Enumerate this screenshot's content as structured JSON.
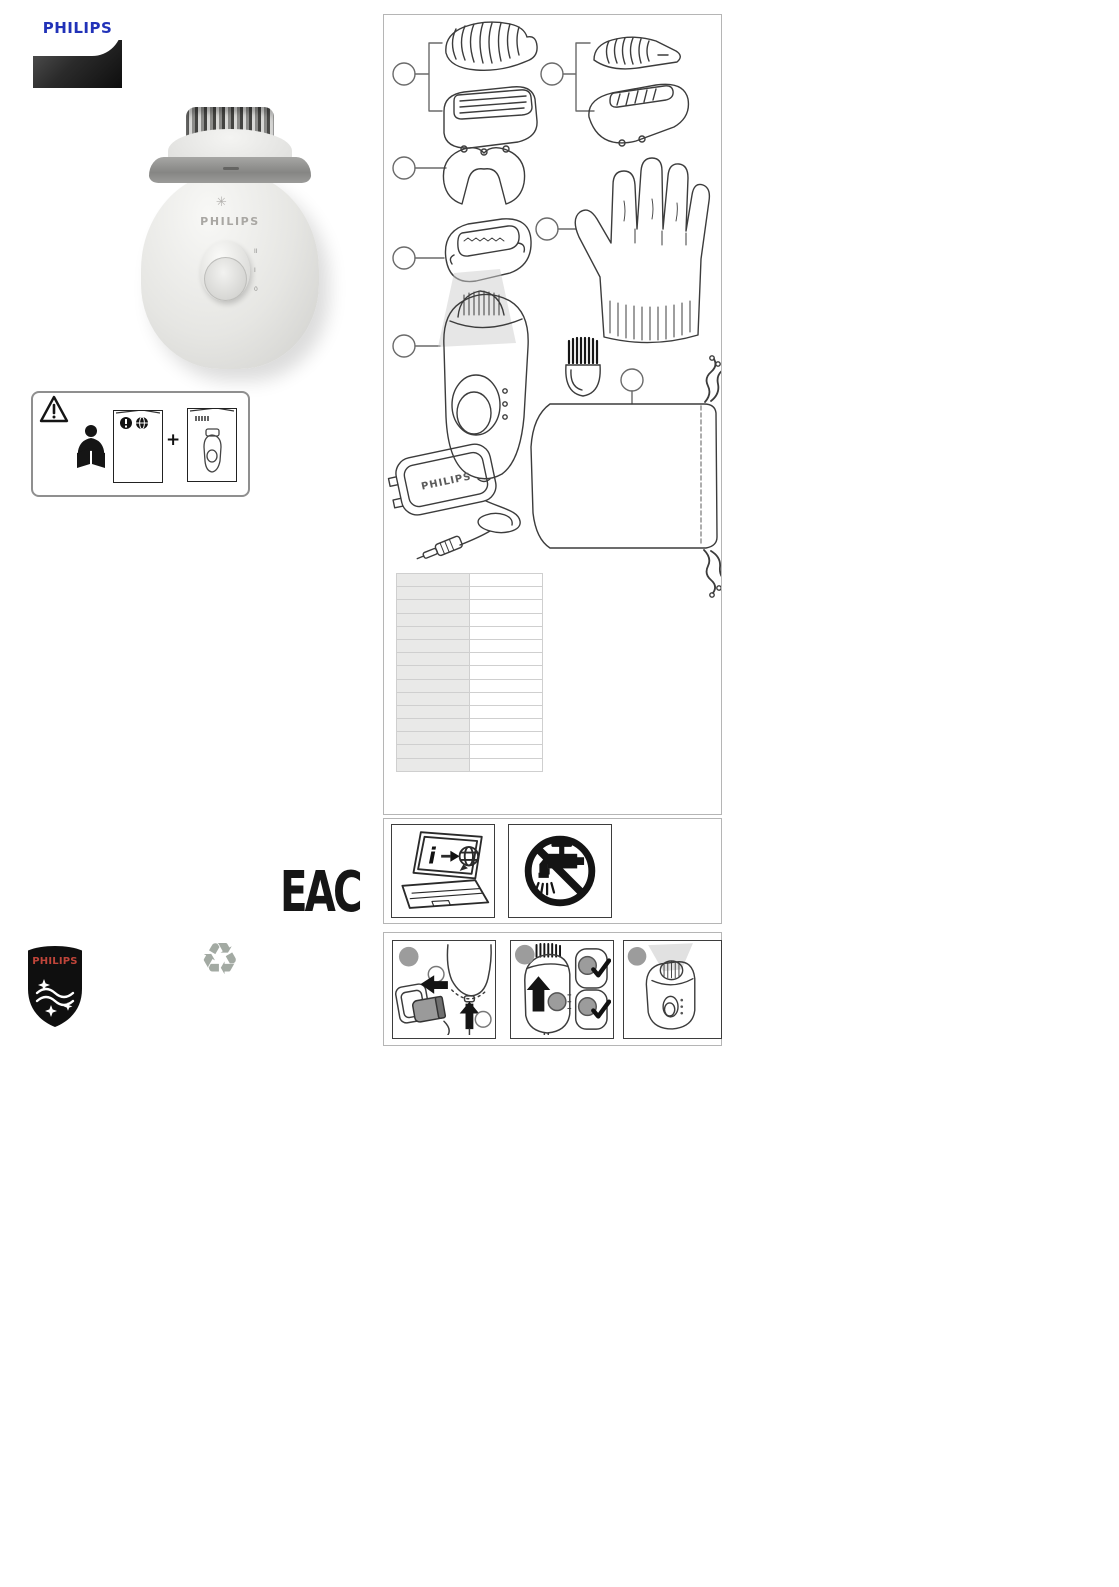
{
  "header_logo": {
    "text": "PHILIPS",
    "text_color": "#2132b8"
  },
  "device_photo": {
    "brand_text": "PHILIPS",
    "dial_marks": [
      "II",
      "I",
      "0"
    ],
    "light_icon": "✳"
  },
  "safety_box": {
    "plus": "+",
    "icons": [
      "warning-triangle-icon",
      "reader-icon",
      "safety-booklet-icon",
      "user-manual-booklet-icon"
    ]
  },
  "package_box": {
    "callout_count": 7,
    "items": [
      "shaving-comb-attachment",
      "shaving-head",
      "trimming-comb-attachment",
      "trimming-head",
      "massage-cap",
      "efficiency-cap",
      "glove",
      "epilator-body",
      "cleaning-brush",
      "pouch",
      "power-adapter"
    ]
  },
  "adapter": {
    "brand_text": "PHILIPS"
  },
  "spec_table": {
    "rows": 15,
    "cols": 2,
    "cells": [
      [
        "",
        ""
      ],
      [
        "",
        ""
      ],
      [
        "",
        ""
      ],
      [
        "",
        ""
      ],
      [
        "",
        ""
      ],
      [
        "",
        ""
      ],
      [
        "",
        ""
      ],
      [
        "",
        ""
      ],
      [
        "",
        ""
      ],
      [
        "",
        ""
      ],
      [
        "",
        ""
      ],
      [
        "",
        ""
      ],
      [
        "",
        ""
      ],
      [
        "",
        ""
      ],
      [
        "",
        ""
      ]
    ]
  },
  "info_icons": {
    "items": [
      {
        "name": "online-info-laptop-icon"
      },
      {
        "name": "do-not-rinse-icon"
      }
    ]
  },
  "steps": {
    "items": [
      {
        "name": "step-plug-in"
      },
      {
        "name": "step-switch-on"
      },
      {
        "name": "step-light"
      }
    ]
  },
  "eac": {
    "text": "EAC"
  },
  "recycle": {
    "glyph": "♻"
  },
  "footer_shield": {
    "text": "PHILIPS",
    "text_color": "#c0453a"
  }
}
